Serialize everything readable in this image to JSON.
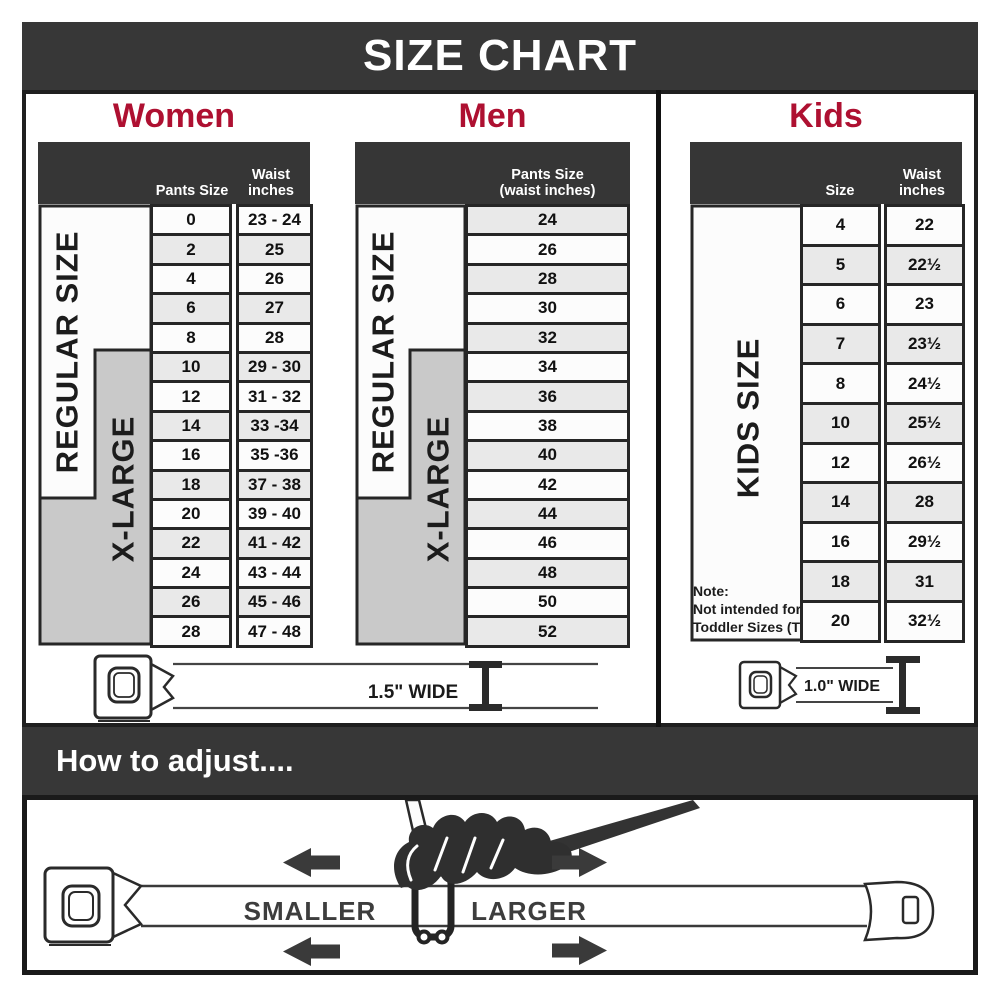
{
  "title": "SIZE CHART",
  "colors": {
    "accent": "#AE1031",
    "dark_bar": "#373737",
    "row_alt": "#e9e9e9",
    "xlarge_gray": "#c9c9c9"
  },
  "women": {
    "heading": "Women",
    "col_pants": "Pants Size",
    "col_waist": "Waist\ninches",
    "regular_label": "REGULAR SIZE",
    "xlarge_label": "X-LARGE",
    "rows": [
      {
        "size": "0",
        "waist": "23 - 24"
      },
      {
        "size": "2",
        "waist": "25"
      },
      {
        "size": "4",
        "waist": "26"
      },
      {
        "size": "6",
        "waist": "27"
      },
      {
        "size": "8",
        "waist": "28"
      },
      {
        "size": "10",
        "waist": "29 - 30"
      },
      {
        "size": "12",
        "waist": "31 - 32"
      },
      {
        "size": "14",
        "waist": "33 -34"
      },
      {
        "size": "16",
        "waist": "35 -36"
      },
      {
        "size": "18",
        "waist": "37 - 38"
      },
      {
        "size": "20",
        "waist": "39 - 40"
      },
      {
        "size": "22",
        "waist": "41 - 42"
      },
      {
        "size": "24",
        "waist": "43 - 44"
      },
      {
        "size": "26",
        "waist": "45 - 46"
      },
      {
        "size": "28",
        "waist": "47 - 48"
      }
    ]
  },
  "men": {
    "heading": "Men",
    "col_pants": "Pants Size\n(waist inches)",
    "regular_label": "REGULAR SIZE",
    "xlarge_label": "X-LARGE",
    "rows": [
      "24",
      "26",
      "28",
      "30",
      "32",
      "34",
      "36",
      "38",
      "40",
      "42",
      "44",
      "46",
      "48",
      "50",
      "52"
    ]
  },
  "kids": {
    "heading": "Kids",
    "col_size": "Size",
    "col_waist": "Waist\ninches",
    "size_label": "KIDS SIZE",
    "note": "Note:\nNot intended for\nToddler Sizes (T)",
    "rows": [
      {
        "size": "4",
        "waist": "22"
      },
      {
        "size": "5",
        "waist": "22½"
      },
      {
        "size": "6",
        "waist": "23"
      },
      {
        "size": "7",
        "waist": "23½"
      },
      {
        "size": "8",
        "waist": "24½"
      },
      {
        "size": "10",
        "waist": "25½"
      },
      {
        "size": "12",
        "waist": "26½"
      },
      {
        "size": "14",
        "waist": "28"
      },
      {
        "size": "16",
        "waist": "29½"
      },
      {
        "size": "18",
        "waist": "31"
      },
      {
        "size": "20",
        "waist": "32½"
      }
    ]
  },
  "belts": {
    "adult_width_label": "1.5\" WIDE",
    "kids_width_label": "1.0\" WIDE"
  },
  "adjust": {
    "heading": "How to adjust....",
    "smaller_label": "SMALLER",
    "larger_label": "LARGER"
  }
}
